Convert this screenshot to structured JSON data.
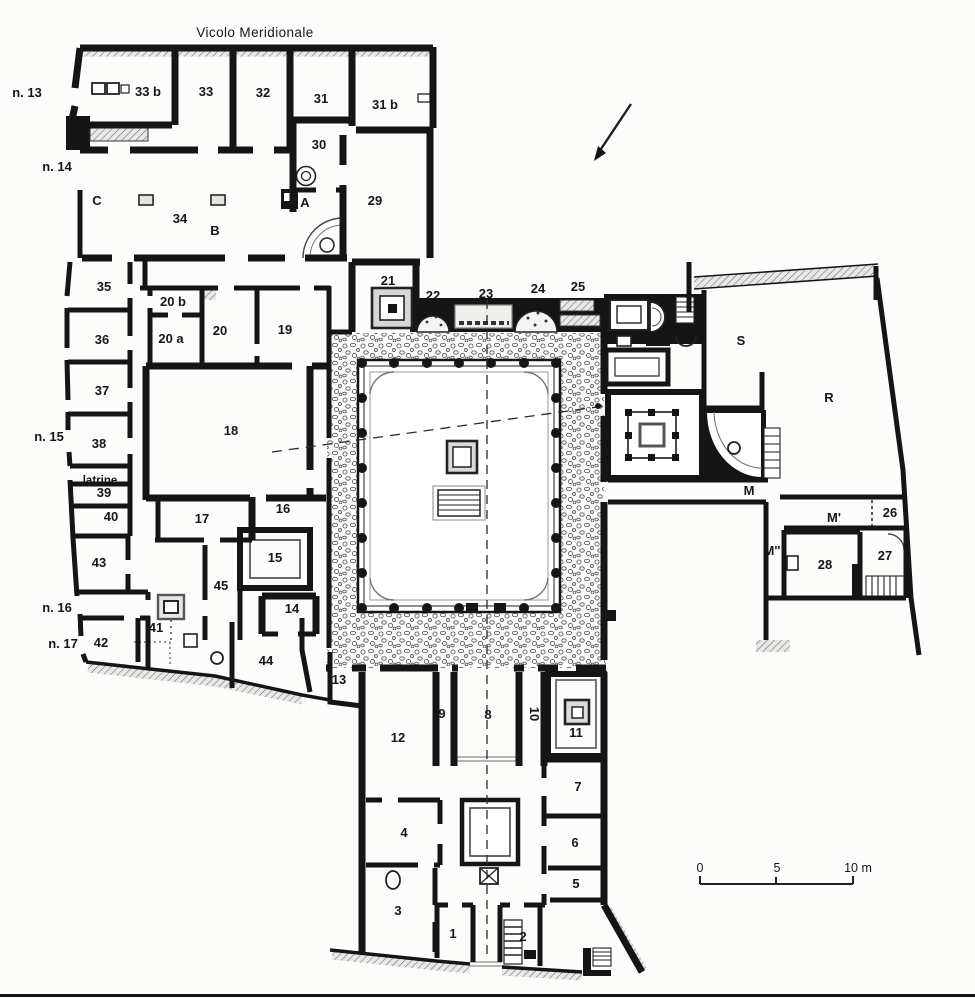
{
  "title": {
    "street": "Vicolo Meridionale"
  },
  "scale_bar": {
    "start": "0",
    "mid": "5",
    "end": "10 m"
  },
  "street_entrances": {
    "n13": "n. 13",
    "n14": "n. 14",
    "n15": "n. 15",
    "n16": "n. 16",
    "n17": "n. 17"
  },
  "annotations": {
    "latrine": "latrine"
  },
  "rooms": {
    "r33b": "33 b",
    "r33": "33",
    "r32": "32",
    "r31": "31",
    "r31b": "31 b",
    "r30": "30",
    "r29": "29",
    "rC": "C",
    "r34": "34",
    "rB": "B",
    "rA": "A",
    "r35": "35",
    "r36": "36",
    "r37": "37",
    "r38": "38",
    "r39": "39",
    "r40": "40",
    "r41": "41",
    "r42": "42",
    "r43": "43",
    "r44": "44",
    "r45": "45",
    "r20b": "20 b",
    "r20a": "20 a",
    "r20": "20",
    "r19": "19",
    "r18": "18",
    "r17": "17",
    "r16": "16",
    "r15": "15",
    "r14": "14",
    "r13": "13",
    "r21": "21",
    "r22": "22",
    "r23": "23",
    "r24": "24",
    "r25": "25",
    "rS": "S",
    "rR": "R",
    "rM": "M",
    "rM1": "M'",
    "rM2": "M''",
    "r26": "26",
    "r27": "27",
    "r28": "28",
    "r12": "12",
    "r11": "11",
    "r10": "10",
    "r9": "9",
    "r8": "8",
    "r7": "7",
    "r6": "6",
    "r5": "5",
    "r4": "4",
    "r3": "3",
    "r2": "2",
    "r1": "1"
  },
  "colors": {
    "ink": "#151515",
    "paper": "#fcfcfb",
    "stipple": "#5e5e5e"
  }
}
